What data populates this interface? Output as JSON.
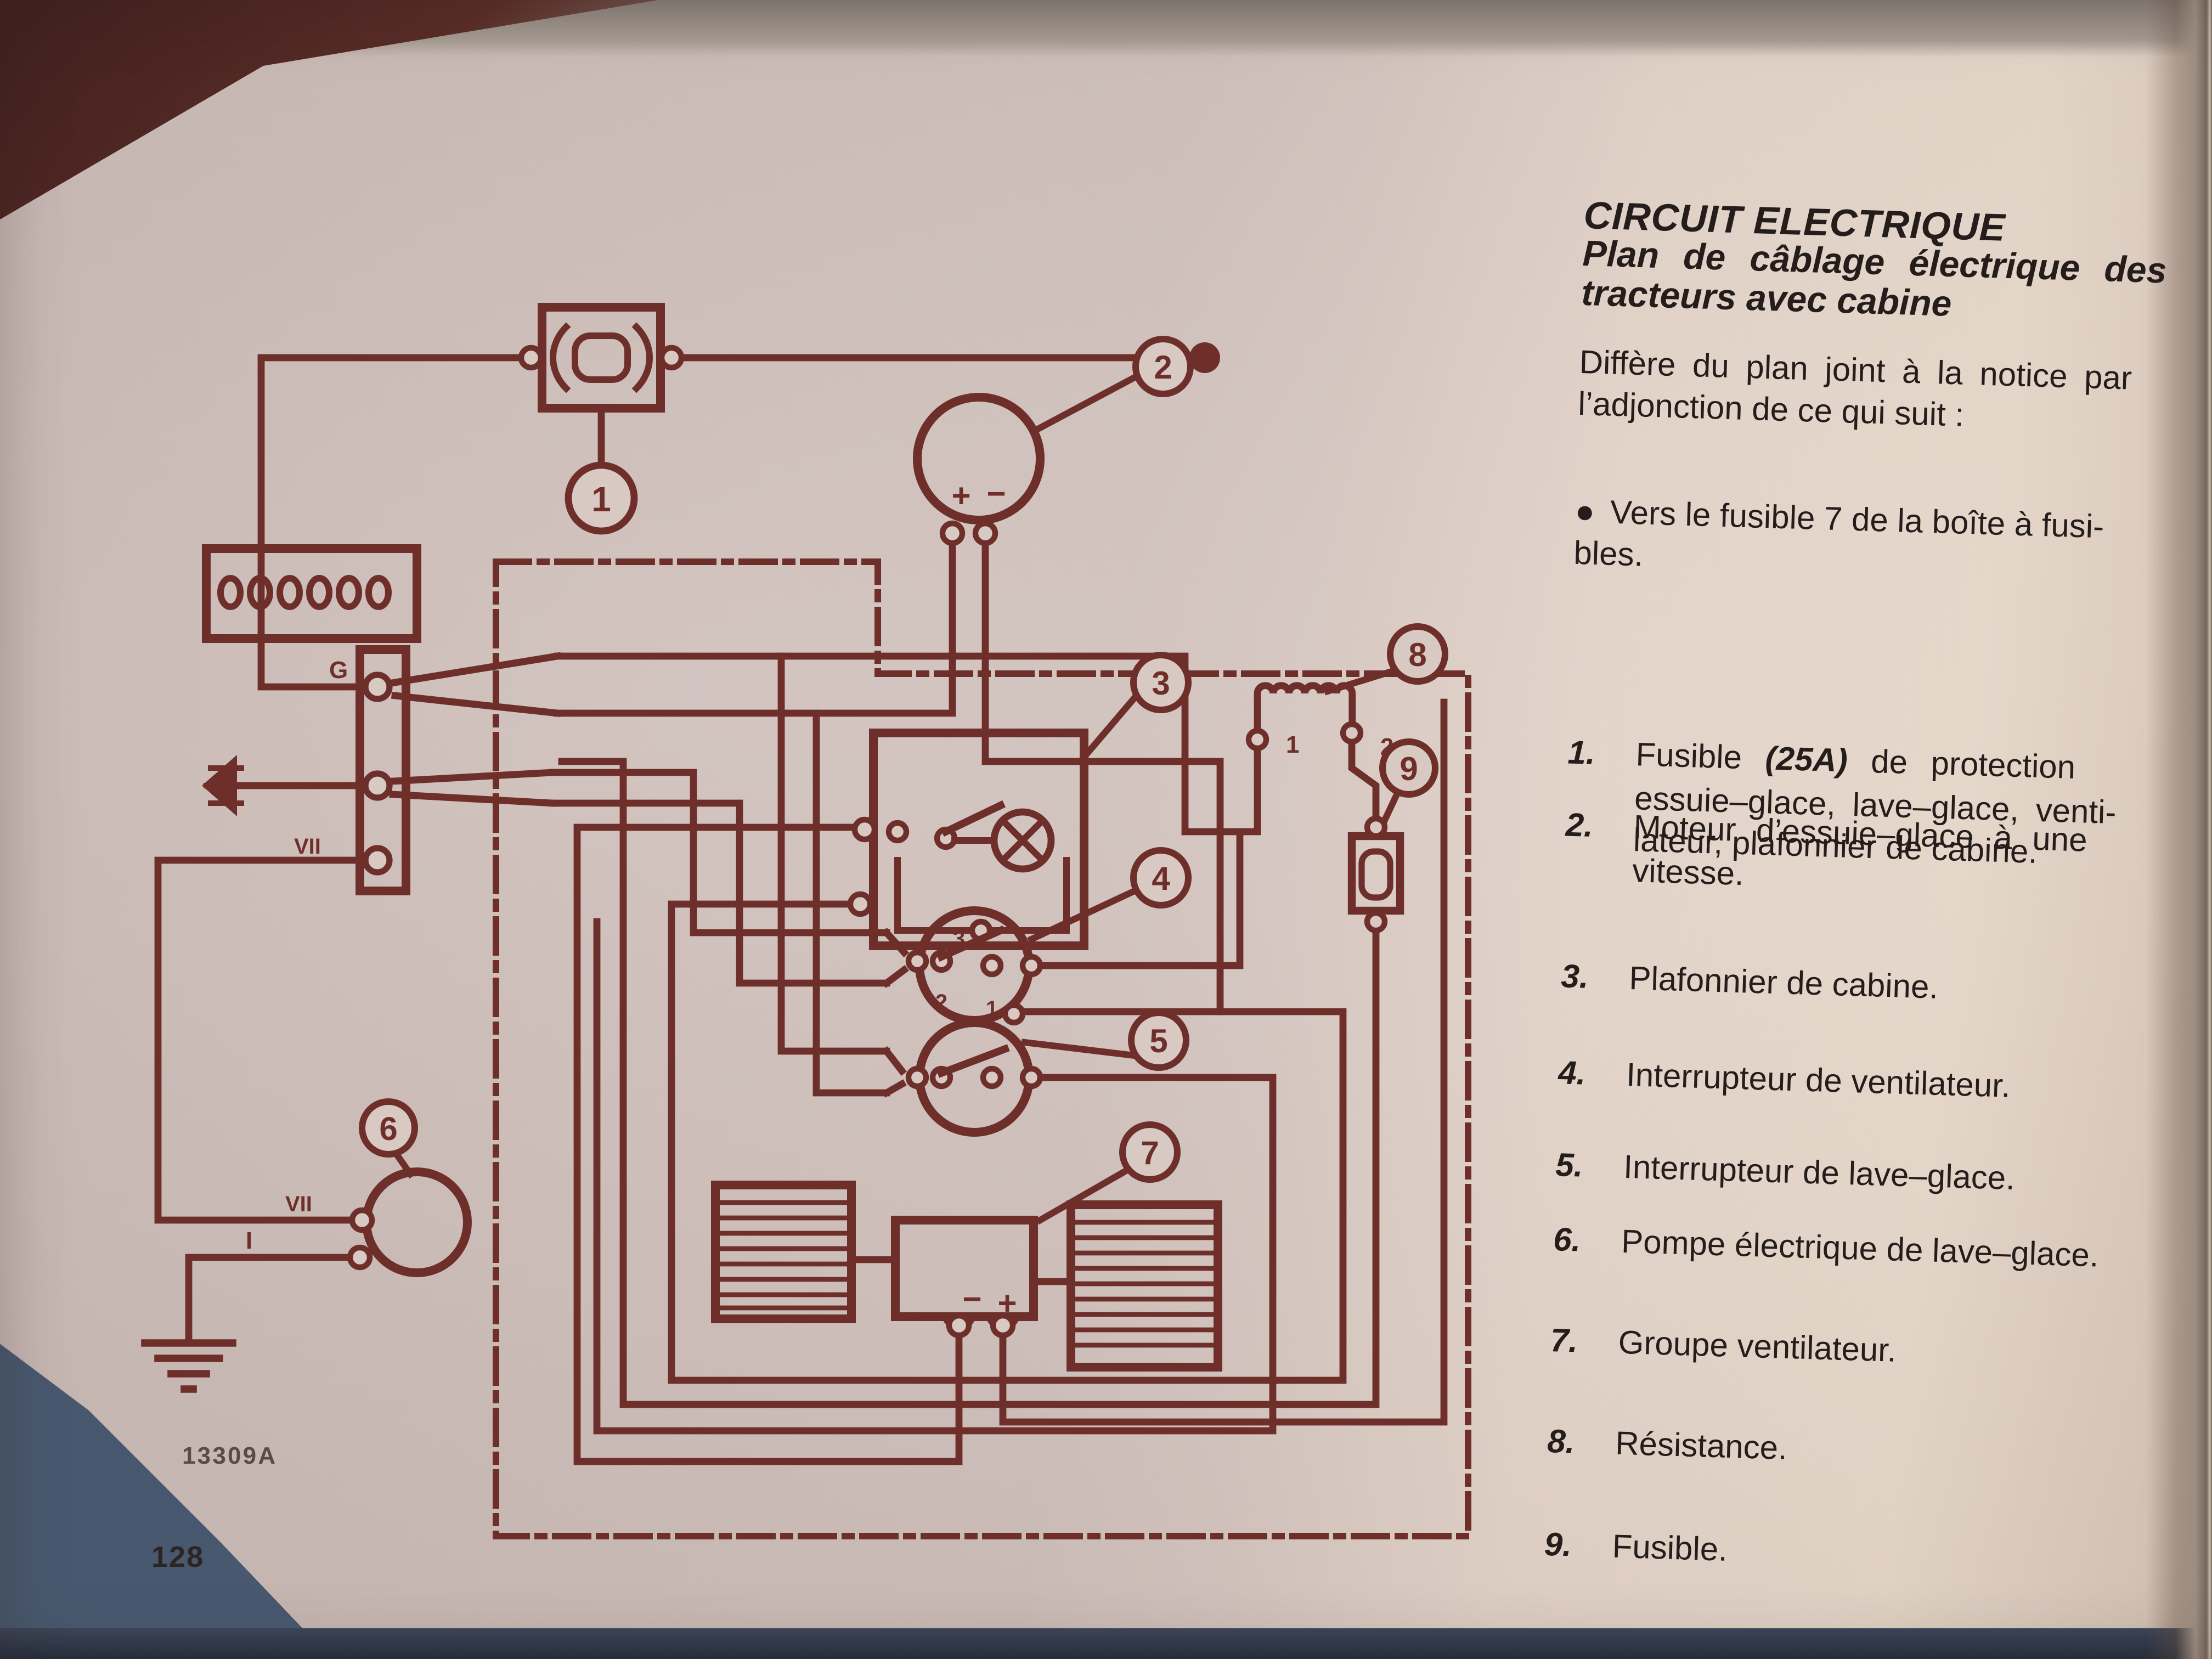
{
  "page": {
    "title": "CIRCUIT ELECTRIQUE",
    "subtitle_lines": [
      "Plan de câblage électrique des",
      "tracteurs avec cabine"
    ],
    "intro_lines": [
      "Diffère du plan joint à la notice par",
      "l’adjonction de ce qui suit :"
    ],
    "bullet": {
      "dot": "●",
      "lines": [
        "Vers le fusible 7 de la boîte à fusi-",
        "bles."
      ]
    },
    "legend": [
      {
        "num": "1.",
        "line0_pre": "Fusible ",
        "line0_bold": "(25A)",
        "line0_post": " de protection",
        "lines": [
          "essuie–glace, lave–glace, venti-",
          "lateur, plafonnier de cabine."
        ]
      },
      {
        "num": "2.",
        "lines": [
          "Moteur d’essuie–glace à une",
          "vitesse."
        ]
      },
      {
        "num": "3.",
        "lines": [
          "Plafonnier de cabine."
        ]
      },
      {
        "num": "4.",
        "lines": [
          "Interrupteur de ventilateur."
        ]
      },
      {
        "num": "5.",
        "lines": [
          "Interrupteur de lave–glace."
        ]
      },
      {
        "num": "6.",
        "lines": [
          "Pompe électrique de lave–glace."
        ]
      },
      {
        "num": "7.",
        "lines": [
          "Groupe ventilateur."
        ]
      },
      {
        "num": "8.",
        "lines": [
          "Résistance."
        ]
      },
      {
        "num": "9.",
        "lines": [
          "Fusible."
        ]
      }
    ],
    "figure_code": "13309A",
    "page_number": "128"
  },
  "diagram": {
    "callouts": [
      "1",
      "2",
      "3",
      "4",
      "5",
      "6",
      "7",
      "8",
      "9"
    ],
    "labels": {
      "g_terminal": "G",
      "vii_connector": "VII",
      "vii_pump": "VII",
      "i_pump": "I",
      "coil_t1": "1",
      "coil_t2": "2",
      "sw4_t3": "3",
      "sw4_t2": "2",
      "sw4_t1": "1",
      "motor_plus": "+",
      "motor_minus": "−",
      "fan_minus": "−",
      "fan_plus": "+"
    },
    "colors": {
      "ink": "#6E2F2B",
      "paper": "#D8C9C3"
    }
  }
}
